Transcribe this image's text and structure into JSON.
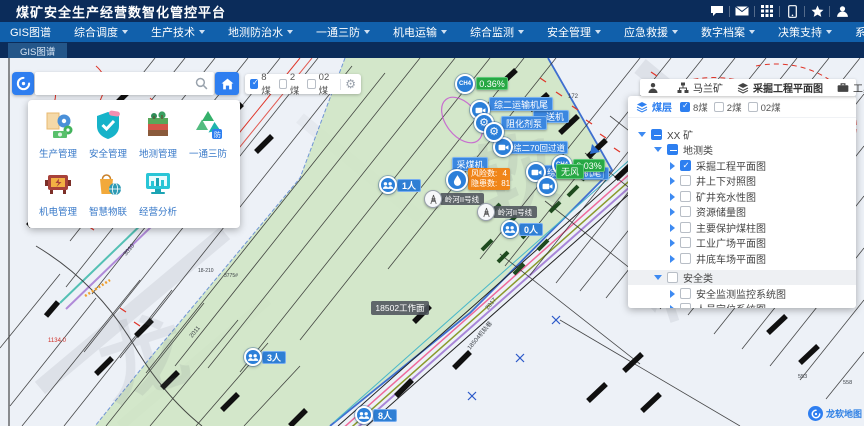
{
  "app": {
    "title": "煤矿安全生产经营数智化管控平台"
  },
  "nav": {
    "items": [
      {
        "label": "GIS图谱",
        "dropdown": false
      },
      {
        "label": "综合调度",
        "dropdown": true
      },
      {
        "label": "生产技术",
        "dropdown": true
      },
      {
        "label": "地测防治水",
        "dropdown": true
      },
      {
        "label": "一通三防",
        "dropdown": true
      },
      {
        "label": "机电运输",
        "dropdown": true
      },
      {
        "label": "综合监测",
        "dropdown": true
      },
      {
        "label": "安全管理",
        "dropdown": true
      },
      {
        "label": "应急救援",
        "dropdown": true
      },
      {
        "label": "数字档案",
        "dropdown": true
      },
      {
        "label": "决策支持",
        "dropdown": true
      },
      {
        "label": "系统管理",
        "dropdown": true
      }
    ]
  },
  "tabs": {
    "active": "GIS图谱"
  },
  "layer_toggle": {
    "items": [
      {
        "label": "8煤",
        "checked": true
      },
      {
        "label": "2煤",
        "checked": false
      },
      {
        "label": "02煤",
        "checked": false
      }
    ]
  },
  "app_menu": {
    "items": [
      {
        "label": "生产管理"
      },
      {
        "label": "安全管理"
      },
      {
        "label": "地测管理"
      },
      {
        "label": "一通三防"
      },
      {
        "label": "机电管理"
      },
      {
        "label": "智慧物联"
      },
      {
        "label": "经营分析"
      }
    ]
  },
  "right_panel": {
    "header": {
      "mine": "马兰矿",
      "map_name": "采掘工程平面图",
      "tools": "工具"
    },
    "seam_row": {
      "label": "煤层",
      "items": [
        {
          "label": "8煤",
          "checked": true
        },
        {
          "label": "2煤",
          "checked": false
        },
        {
          "label": "02煤",
          "checked": false
        }
      ]
    },
    "tree": [
      {
        "label": "XX 矿"
      },
      {
        "label": "地测类"
      },
      {
        "label": "采掘工程平面图"
      },
      {
        "label": "井上下对照图"
      },
      {
        "label": "矿井充水性图"
      },
      {
        "label": "资源储量图"
      },
      {
        "label": "主要保护煤柱图"
      },
      {
        "label": "工业广场平面图"
      },
      {
        "label": "井底车场平面图"
      },
      {
        "label": "安全类"
      },
      {
        "label": "安全监测监控系统图"
      },
      {
        "label": "人员定位系统图"
      }
    ]
  },
  "markers": {
    "ch4_high": {
      "gas": "CH4",
      "value": "0.36%"
    },
    "ch4_low": {
      "gas": "CH4",
      "value": "0.03%"
    },
    "conveyor_tail": "综二运输机尾",
    "inhibitor_pump": "阻化剂泵",
    "equipment_fragment": "送机",
    "crossheading": "综二70回过道",
    "return_air_tail": "综二回风机尾",
    "wind_sensor": "无风",
    "tail_fragment": "机尾",
    "shearer": "采煤机",
    "risk_box": {
      "rows": [
        {
          "label": "风险数:",
          "value": "4"
        },
        {
          "label": "隐患数:",
          "value": "81"
        }
      ]
    },
    "power_line": "岭河II号线",
    "people": [
      "1人",
      "0人",
      "3人",
      "8人"
    ],
    "workface": "18502工作面"
  },
  "map_texts": {
    "elev_172": "172",
    "t2017": "2017",
    "t3010": "3010",
    "t2011": "2011",
    "red_point": "1134.0",
    "track_road": "18504机轨巷",
    "t18210": "18-210",
    "t3775": "3775#",
    "t553": "553",
    "t558": "558"
  },
  "map_logo": "龙软地图",
  "watermark": [
    "龙",
    "软",
    "科"
  ],
  "colors": {
    "accent_blue": "#2d7ff0",
    "label_blue": "#3b87e0",
    "sensor_green": "#27a844",
    "risk_orange": "#f08519",
    "header_navy": "#0b2c5a",
    "menu_blue": "#1160ab"
  }
}
